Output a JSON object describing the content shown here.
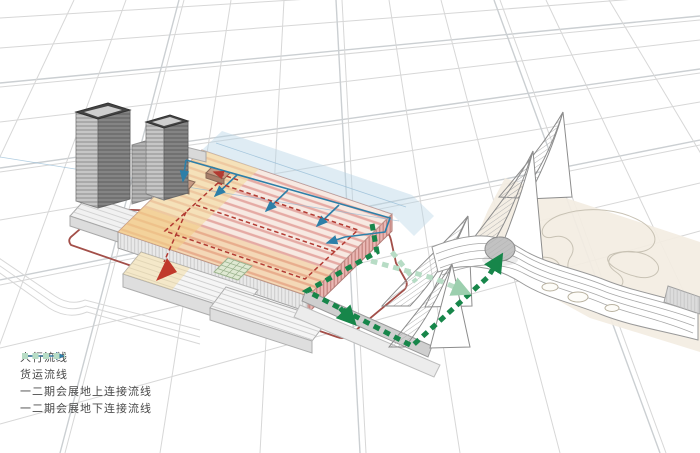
{
  "legend": {
    "items": [
      {
        "id": "pedestrian-flow",
        "label": "人行流线",
        "color": "#b23a32",
        "line_style": "thin-dashed-arrow"
      },
      {
        "id": "freight-flow",
        "label": "货运流线",
        "color": "#2d7fa8",
        "line_style": "thin-solid-arrow"
      },
      {
        "id": "phase12-above-ground-link",
        "label": "一二期会展地上连接流线",
        "color": "#17864a",
        "line_style": "thick-dashed"
      },
      {
        "id": "phase12-underground-link",
        "label": "一二期会展地下连接流线",
        "color": "#b7dcc5",
        "line_style": "thick-dashed"
      }
    ]
  },
  "colors": {
    "site_perimeter_road": "#a34f49",
    "roof_stripe_pink": "#e09a94",
    "roof_yellow_zone": "#f3dc9e",
    "roof_orange_zone": "#f0b35e",
    "glass_band_blue": "#b7d4e6",
    "building_gray": "#8f8f8f",
    "map_line_gray": "#d7d7d7",
    "park_beige": "#f3ede2"
  }
}
